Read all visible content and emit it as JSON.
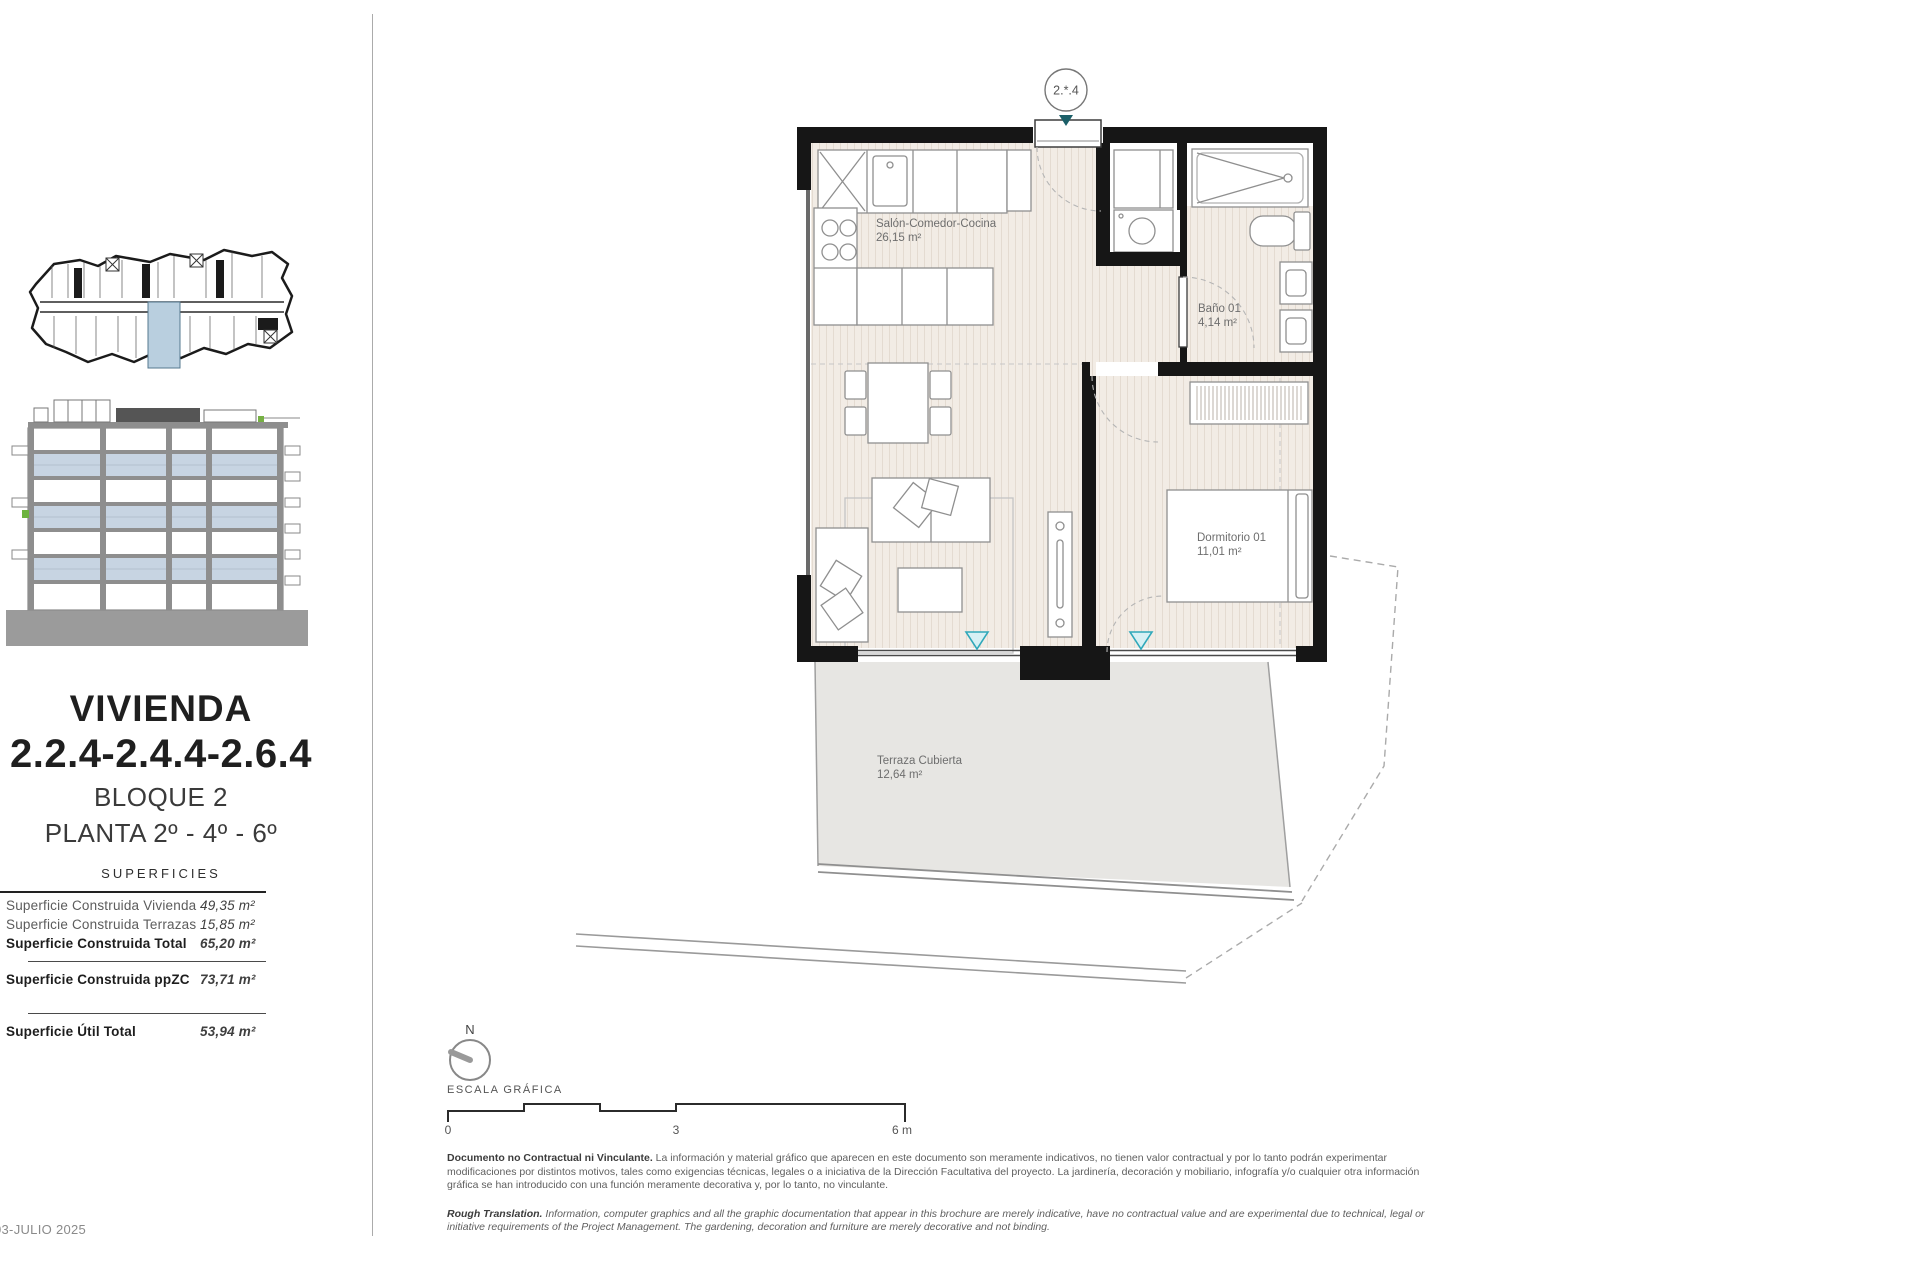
{
  "page": {
    "date": "03-JULIO 2025"
  },
  "sidebar": {
    "title": "VIVIENDA",
    "unit_codes": "2.2.4-2.4.4-2.6.4",
    "block": "BLOQUE 2",
    "floors": "PLANTA 2º - 4º - 6º",
    "table_header": "SUPERFICIES",
    "surfaces": [
      {
        "label": "Superficie Construida Vivienda",
        "value": "49,35 m²"
      },
      {
        "label": "Superficie Construida Terrazas",
        "value": "15,85 m²"
      },
      {
        "label": "Superficie Construida Total",
        "value": "65,20 m²"
      },
      {
        "label": "Superficie Construida ppZC",
        "value": "73,71 m²"
      },
      {
        "label": "Superficie Útil Total",
        "value": "53,94 m²"
      }
    ]
  },
  "plan": {
    "marker": "2.*.4",
    "rooms": [
      {
        "name": "Salón-Comedor-Cocina",
        "area": "26,15 m²"
      },
      {
        "name": "Baño 01",
        "area": "4,14 m²"
      },
      {
        "name": "Dormitorio 01",
        "area": "11,01 m²"
      },
      {
        "name": "Terraza Cubierta",
        "area": "12,64 m²"
      }
    ]
  },
  "scalebar": {
    "north": "N",
    "label": "ESCALA GRÁFICA",
    "tick0": "0",
    "tick3": "3",
    "tick6": "6 m"
  },
  "disclaimer": {
    "es_lead": "Documento no Contractual ni Vinculante.",
    "es_body": " La información y material gráfico que aparecen en este documento son meramente indicativos, no tienen valor contractual y por lo tanto podrán experimentar modificaciones por distintos motivos, tales como exigencias técnicas, legales o a iniciativa de la Dirección Facultativa del proyecto. La jardinería, decoración y mobiliario, infografía y/o cualquier otra información gráfica se han introducido con una función meramente decorativa y, por lo tanto, no vinculante.",
    "en_lead": "Rough Translation.",
    "en_body": " Information, computer graphics and all the graphic documentation that appear in this brochure are merely indicative, have no contractual value and are experimental due to technical, legal or initiative requirements of the Project Management. The gardening, decoration and furniture are merely decorative and not binding."
  },
  "colors": {
    "wall": "#161616",
    "floor": "#f2ece5",
    "terrace": "#e7e6e3",
    "accent_teal": "#2fa8ba",
    "entrance_marker": "#1b5f68",
    "elevation_blue": "#c7d4e2",
    "keyplan_highlight": "#b9cfdf"
  }
}
